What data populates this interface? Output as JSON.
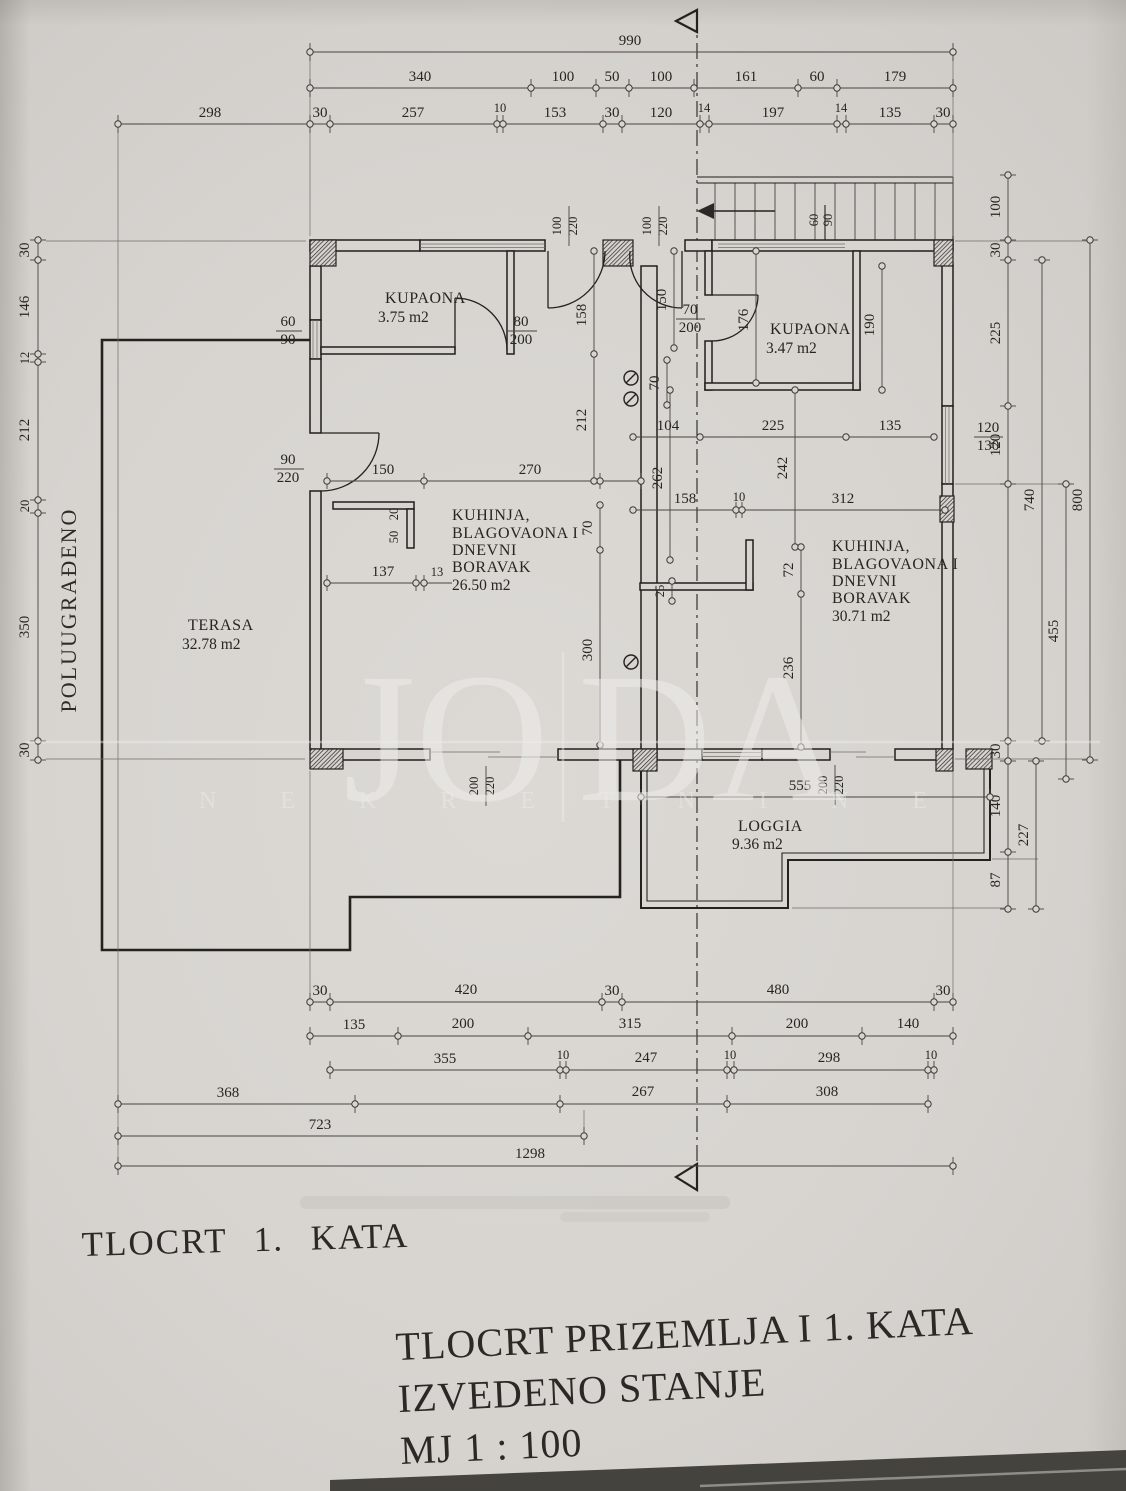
{
  "side_label": "POLUUGRAĐENO",
  "titles": {
    "left": "TLOCRT 1. KATA",
    "main1": "TLOCRT PRIZEMLJA I 1. KATA",
    "main2": "IZVEDENO STANJE",
    "main3": "MJ 1 : 100"
  },
  "watermark": {
    "left": "JO",
    "right": "DA",
    "subtitle": "NEKRETNINE"
  },
  "rooms": {
    "bath_left": {
      "name": "KUPAONA",
      "area": "3.75 m2"
    },
    "bath_right": {
      "name": "KUPAONA",
      "area": "3.47 m2"
    },
    "living_left": {
      "l1": "KUHINJA,",
      "l2": "BLAGOVAONA I",
      "l3": "DNEVNI",
      "l4": "BORAVAK",
      "area": "26.50 m2"
    },
    "living_right": {
      "l1": "KUHINJA,",
      "l2": "BLAGOVAONA I",
      "l3": "DNEVNI",
      "l4": "BORAVAK",
      "area": "30.71 m2"
    },
    "terrace": {
      "name": "TERASA",
      "area": "32.78 m2"
    },
    "loggia": {
      "name": "LOGGIA",
      "area": "9.36 m2"
    }
  },
  "dims": {
    "top": [
      "990",
      "340",
      "100",
      "50",
      "100",
      "161",
      "60",
      "179",
      "298",
      "30",
      "257",
      "10",
      "153",
      "30",
      "120",
      "14",
      "197",
      "14",
      "135",
      "30"
    ],
    "left": [
      "30",
      "146",
      "12",
      "212",
      "20",
      "350",
      "30"
    ],
    "right": [
      "100",
      "30",
      "225",
      "120",
      "740",
      "455",
      "800",
      "30",
      "140",
      "87",
      "227",
      "120",
      "130"
    ],
    "bottom": [
      "30",
      "420",
      "30",
      "480",
      "30",
      "135",
      "200",
      "315",
      "200",
      "140",
      "355",
      "10",
      "247",
      "10",
      "298",
      "10",
      "368",
      "267",
      "308",
      "723",
      "1298"
    ],
    "inner_left": [
      "100",
      "220",
      "100",
      "220",
      "158",
      "212",
      "80",
      "200",
      "60",
      "90",
      "90",
      "220",
      "150",
      "270",
      "20",
      "50",
      "137",
      "13",
      "70",
      "300",
      "200",
      "220"
    ],
    "inner_right": [
      "150",
      "70",
      "200",
      "176",
      "190",
      "60",
      "90",
      "104",
      "225",
      "135",
      "242",
      "262",
      "158",
      "10",
      "312",
      "25",
      "72",
      "236",
      "70",
      "555",
      "200",
      "220"
    ]
  }
}
